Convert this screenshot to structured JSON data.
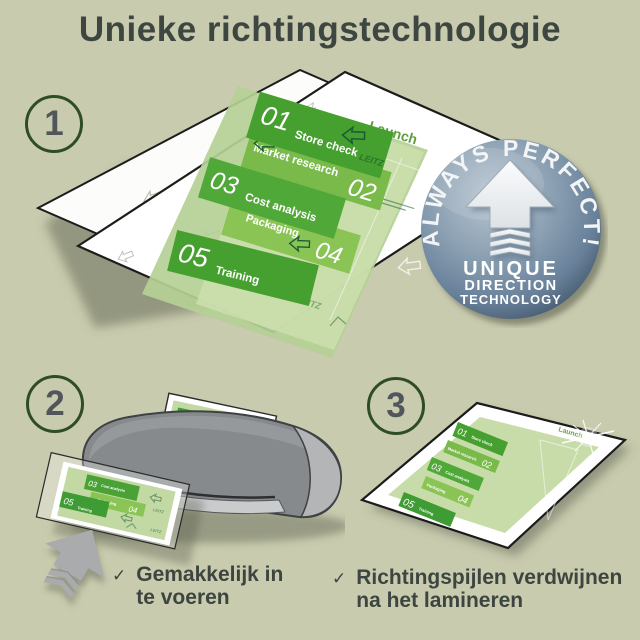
{
  "title": "Unieke richtingstechnologie",
  "steps": {
    "one": "1",
    "two": "2",
    "three": "3"
  },
  "document": {
    "watermark": "LEITZ",
    "launch_label": "Launch",
    "items": [
      {
        "num": "01",
        "label": "Store check"
      },
      {
        "num": "02",
        "label": "Market research"
      },
      {
        "num": "03",
        "label": "Cost analysis"
      },
      {
        "num": "04",
        "label": "Packaging"
      },
      {
        "num": "05",
        "label": "Training"
      }
    ]
  },
  "badge": {
    "arc_text": "ALWAYS PERFECT!",
    "line1": "UNIQUE",
    "line2": "DIRECTION",
    "line3": "TECHNOLOGY"
  },
  "captions": [
    {
      "check": "✓",
      "line1": "Gemakkelijk in",
      "line2": "te voeren"
    },
    {
      "check": "✓",
      "line1": "Richtingspijlen verdwijnen",
      "line2": "na het lamineren"
    }
  ],
  "colors": {
    "background": "#c9cbae",
    "title_text": "#3d4641",
    "circle_stroke": "#2e4d26",
    "green_dark_box": "#46a02f",
    "green_light_box": "#8ac455",
    "green_mid_box": "#79ba4b",
    "sheet_green": "#bcd59d",
    "badge_face": "#7e95aa",
    "badge_rim": "#47607a",
    "laminator_gray": "#868a8d",
    "arrow_gray": "#a9abac"
  }
}
